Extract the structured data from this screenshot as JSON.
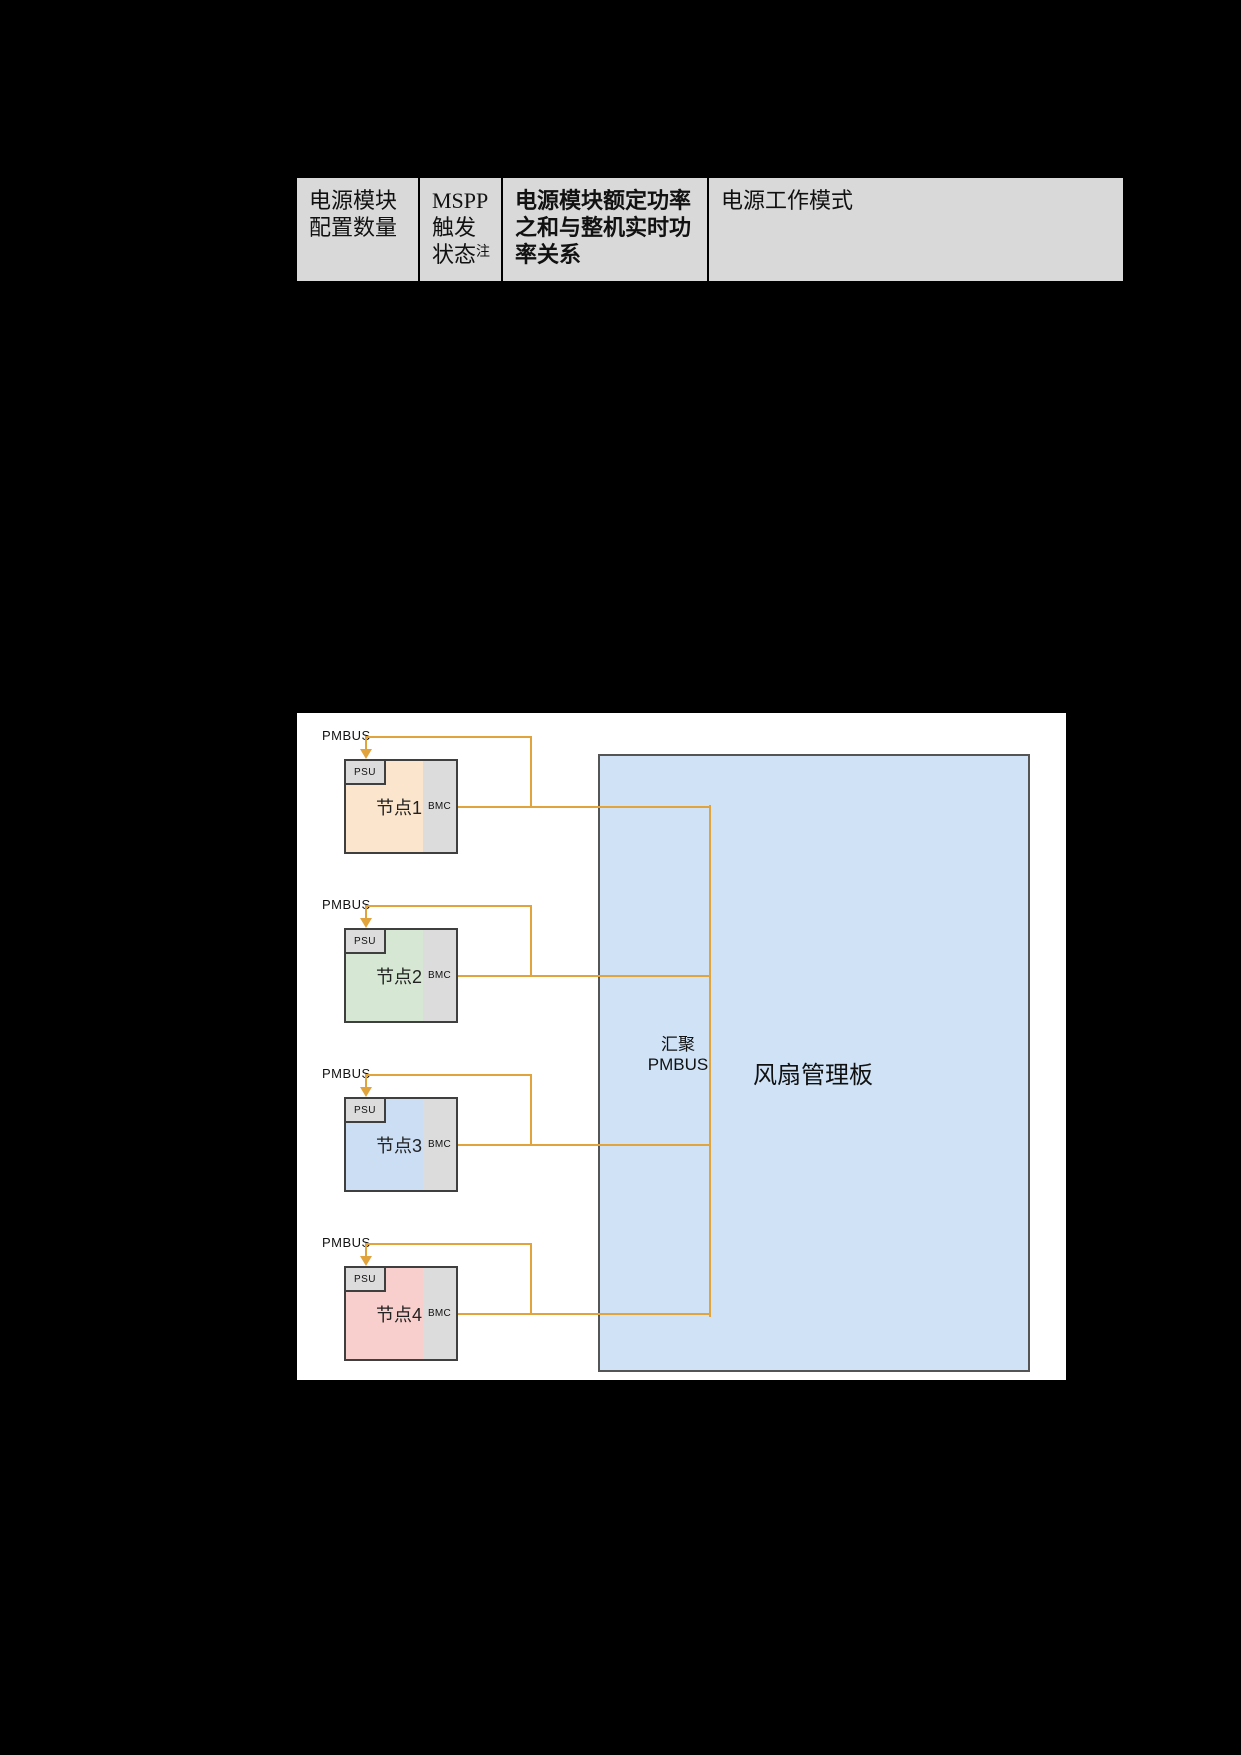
{
  "page": {
    "background": "#000000"
  },
  "table": {
    "background": "#D9D9D9",
    "columns": [
      {
        "name": "psu-count",
        "lines": [
          "电源模块",
          "配置数量"
        ]
      },
      {
        "name": "mspp-status",
        "lines": [
          "MSPP",
          "触发",
          "状态"
        ],
        "superscript": "注"
      },
      {
        "name": "power-relation",
        "lines": [
          "电源模块额定功率",
          "之和与整机实时功",
          "率关系"
        ]
      },
      {
        "name": "work-mode",
        "lines": [
          "电源工作模式"
        ]
      }
    ]
  },
  "diagram": {
    "background": "#FFFFFF",
    "nodes": [
      {
        "label": "节点1",
        "pmbus": "PMBUS",
        "psu": "PSU",
        "bmc": "BMC",
        "fill": "#FBE5CD"
      },
      {
        "label": "节点2",
        "pmbus": "PMBUS",
        "psu": "PSU",
        "bmc": "BMC",
        "fill": "#D6E8D3"
      },
      {
        "label": "节点3",
        "pmbus": "PMBUS",
        "psu": "PSU",
        "bmc": "BMC",
        "fill": "#CBDEF4"
      },
      {
        "label": "节点4",
        "pmbus": "PMBUS",
        "psu": "PSU",
        "bmc": "BMC",
        "fill": "#F8CFCC"
      }
    ],
    "hub": {
      "line1": "汇聚",
      "line2": "PMBUS"
    },
    "fan_board": {
      "label": "风扇管理板",
      "fill": "#CFE2F6",
      "border": "#555555"
    },
    "colors": {
      "connector": "#E1A33C",
      "component_fill": "#DCDCDC",
      "node_border": "#3F3F3F",
      "table_background": "#D9D9D9"
    }
  }
}
